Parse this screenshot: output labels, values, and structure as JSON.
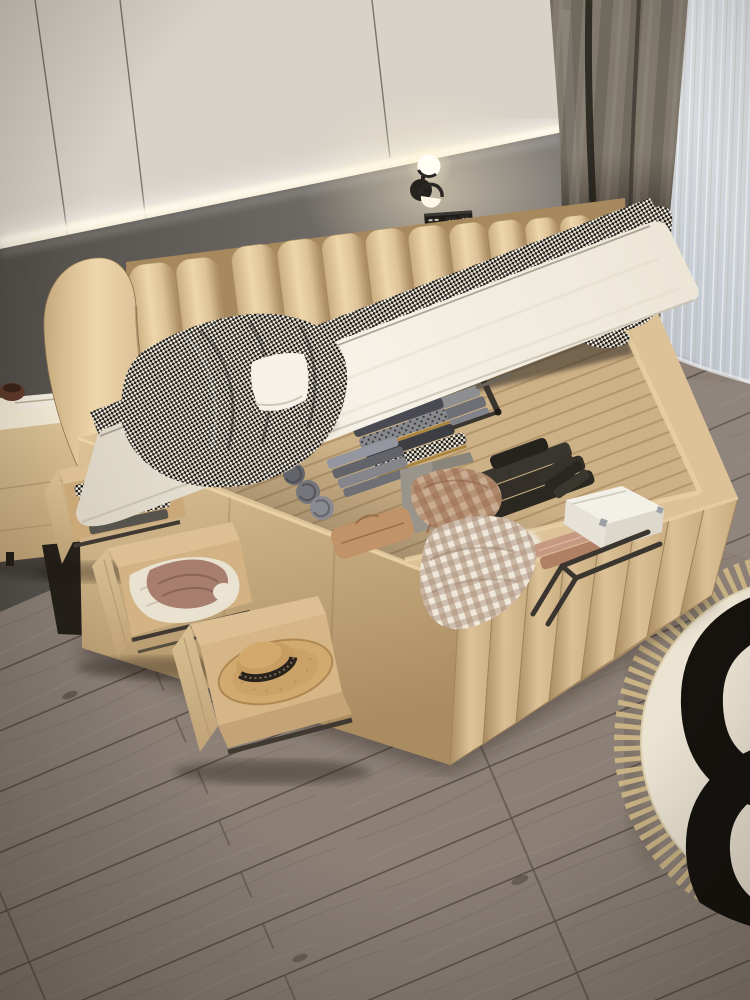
{
  "meta": {
    "description": "Bedroom product photo: beige leather hydraulic storage bed with mattress lifted open, under-bed storage full of folded clothes, three open side drawers, houndstooth blanket, wall cove light, sconce, nightstands, gray wood floor, round fringed rug",
    "visible_text": ""
  },
  "colors": {
    "wall_upper": "#d8d2c8",
    "wall_upper_bright": "#efe7d6",
    "wall_seam": "#5a554c",
    "glow": "#fff6dd",
    "band_left": "#514d48",
    "band_right": "#847f7b",
    "curtain_hi": "#81796c",
    "curtain_lo": "#5d554b",
    "curtain_slit": "#211e19",
    "sheer_base": "#b7bfc8",
    "sheer_hi": "#dde1e5",
    "sheer_stripe": "#baa98c",
    "window": "#e9ecee",
    "floor_base": "#8b7f76",
    "floor_dark": "#6e635a",
    "floor_seam": "#5c5249",
    "floor_light": "#9b9086",
    "rug_base": "#ebe3d2",
    "rug_black": "#16130f",
    "rug_fringe": "#c9b384",
    "leather_hi": "#eed7ab",
    "leather": "#ddc298",
    "leather_mid": "#c9ad80",
    "leather_dark": "#a98c60",
    "leather_deep": "#8c7350",
    "mattress_hi": "#f7f2e7",
    "mattress": "#ece5d6",
    "mattress_shade": "#d9d2c2",
    "hound_dark": "#201d19",
    "hound_light": "#ece6da",
    "wood_slat": "#cdb186",
    "wood_slat_dark": "#b3966c",
    "wood_drawer": "#dcc094",
    "wood_drawer_side": "#c4a476",
    "interior_shadow": "#2e2822",
    "towel_gray": "#8d8e90",
    "towel_gray_dark": "#63646a",
    "knit_dark": "#39362f",
    "knit_black": "#26231e",
    "plaid_brown": "#9c6e50",
    "plaid_light": "#c8ab90",
    "mauve": "#a87e6f",
    "knit_white": "#eae2d1",
    "gingham_a": "#efe8da",
    "gingham_b": "#a98c77",
    "pouch_tan": "#c09368",
    "hat": "#d0aa6e",
    "hat_dark": "#b08752",
    "hat_band": "#28221b",
    "box_white": "#f3f0e8",
    "box_brown": "#5d4030",
    "box_brown_dark": "#40291d",
    "nightstand": "#d8c093",
    "nightstand_top": "#efe6d1",
    "nightstand_side": "#bfa276",
    "metal_dark": "#3a352e",
    "shadow": "#1c1711",
    "lamp_glow": "#fff3d0",
    "mustard": "#a9853f"
  },
  "objects": {
    "scene": "bedroom with storage bed",
    "wall": "panelled wall with LED cove light and gray accent band",
    "lamp": "black wall sconce with two glowing discs",
    "outlet": "black wall switch and socket panel",
    "curtain": "dark gray curtain",
    "sheer": "light sheer curtain over window",
    "floor": "gray-brown wood plank floor",
    "rug": "round cream rug with black pattern and fringe",
    "nightstand_left": "beige nightstand with book and bowl",
    "nightstand_right": "beige nightstand with brown radio box",
    "headboard": "channel-tufted beige leather headboard with curved wing",
    "bed_base": "beige leather storage bed base with ribbed footboard",
    "storage": "under-bed storage with folded clothes, towels, boxes",
    "drawer1": "open drawer with patterned folded clothes",
    "drawer2": "open drawer with white knit and mauve clothes",
    "drawer3": "open drawer with straw hat",
    "mattress": "lifted white mattress",
    "blanket": "black and white houndstooth blanket",
    "strut": "gas lift strut",
    "handle": "metal lift handle"
  }
}
